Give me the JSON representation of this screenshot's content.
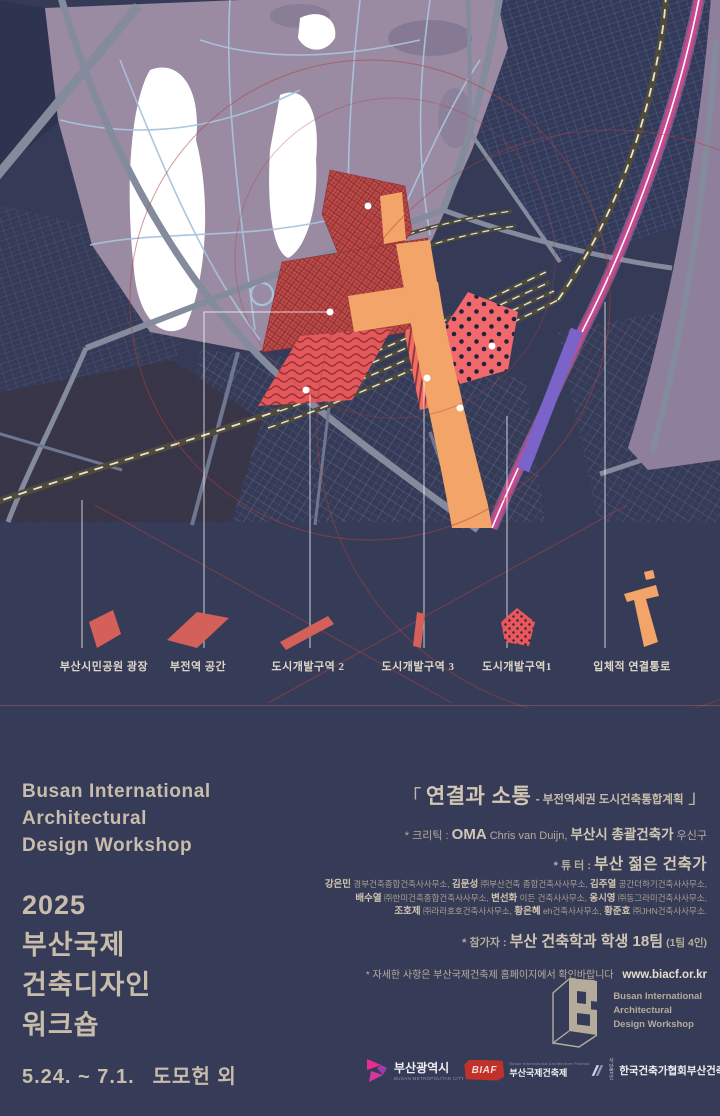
{
  "map": {
    "colors": {
      "background": "#353b57",
      "park": "#9a8aa2",
      "roads": "#848b9c",
      "zone_red": "#c04b48",
      "zone_pink_dots": "#f2696d",
      "connector_orange": "#f2a469",
      "transit_magenta": "#c8498f",
      "transit_purple": "#7a63c9",
      "guide_circles": "#b04040"
    }
  },
  "legend": {
    "items": [
      {
        "label": "부산시민공원 광장",
        "icon": "red-rhombus"
      },
      {
        "label": "부전역 공간",
        "icon": "red-parallelogram"
      },
      {
        "label": "도시개발구역 2",
        "icon": "red-diagonal-bar"
      },
      {
        "label": "도시개발구역 3",
        "icon": "red-small-bar"
      },
      {
        "label": "도시개발구역1",
        "icon": "red-dotted-diamond"
      },
      {
        "label": "입체적 연결통로",
        "icon": "orange-connector"
      }
    ]
  },
  "english_title": {
    "line1": "Busan International",
    "line2": "Architectural",
    "line3": "Design Workshop"
  },
  "korean_title": {
    "year": "2025",
    "line1": "부산국제",
    "line2": "건축디자인",
    "line3": "워크숍"
  },
  "footer": {
    "date": "5.24. ~ 7.1.",
    "venue": "도모헌 외"
  },
  "project": {
    "bracket_open": "「",
    "title": "연결과 소통",
    "subtitle": "- 부전역세권 도시건축통합계획",
    "bracket_close": "」"
  },
  "critic": {
    "label": "* 크리틱 : ",
    "firm": "OMA",
    "person_en": " Chris van Duijn, ",
    "org": "부산시 총괄건축가",
    "person_kr": " 우신구"
  },
  "tutors": {
    "label": "* 튜 터 : ",
    "heading": "부산 젊은 건축가",
    "rows": [
      [
        {
          "b": "강은민"
        },
        {
          "t": " 경부건축종합건축사사무소, "
        },
        {
          "b": "김문성"
        },
        {
          "t": " ㈜부산건축 종합건축사사무소, "
        },
        {
          "b": "김주열"
        },
        {
          "t": " 공간더하기건축사사무소,"
        }
      ],
      [
        {
          "b": "배수열"
        },
        {
          "t": " ㈜한미건축종합건축사사무소, "
        },
        {
          "b": "변선화"
        },
        {
          "t": " 이든 건축사사무소, "
        },
        {
          "b": "옹시영"
        },
        {
          "t": " ㈜동그라미건축사사무소,"
        }
      ],
      [
        {
          "b": "조호제"
        },
        {
          "t": " ㈜라라호호건축사사무소, "
        },
        {
          "b": "황은혜"
        },
        {
          "t": " eh건축사사무소, "
        },
        {
          "b": "황준효"
        },
        {
          "t": " ㈜JHN건축사사무소."
        }
      ]
    ]
  },
  "participants": {
    "label": "* 참가자 : ",
    "main": "부산 건축학과 학생 18팀",
    "note": " (1팀 4인)"
  },
  "notice": {
    "text": "* 자세한 사항은 부산국제건축제 홈페이지에서 확인바랍니다",
    "url": "www.biacf.or.kr"
  },
  "workshop_logo": {
    "line1": "Busan International",
    "line2": "Architectural",
    "line3": "Design Workshop"
  },
  "partners": {
    "busan_city": {
      "name": "부산광역시",
      "sub": "BUSAN METROPOLITAN CITY"
    },
    "biaf": {
      "acronym": "BIAF",
      "sub": "Busan International Architecture Festival",
      "name": "부산국제건축제"
    },
    "kira": {
      "pre1": "사단",
      "pre2": "법인",
      "name": "한국건축가협회부산건축가회"
    }
  }
}
